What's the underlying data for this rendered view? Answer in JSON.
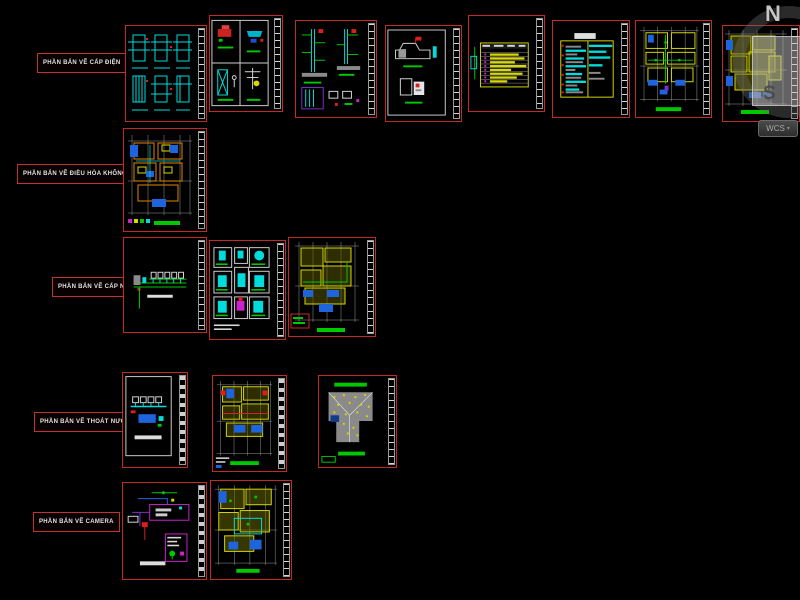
{
  "workspace": {
    "background_color": "#000000",
    "sheet_border_color": "#c22a2a",
    "label_border_color": "#c23232"
  },
  "sections": [
    {
      "label": "PHẦN BẢN VẼ CẤP ĐIỆN"
    },
    {
      "label": "PHẦN BẢN VẼ ĐIỀU HÒA KHÔNG KHÍ"
    },
    {
      "label": "PHẦN BẢN VẼ CẤP NƯỚC"
    },
    {
      "label": "PHẦN BẢN VẼ THOÁT NƯỚC"
    },
    {
      "label": "PHẦN BẢN VẼ CAMERA"
    }
  ],
  "viewcube": {
    "north_label": "N",
    "south_label": "S",
    "wcs_label": "WCS"
  },
  "icons": {
    "dropdown_arrow": "▾"
  },
  "cad_palette": {
    "cyan": "#00dcdc",
    "green": "#00c800",
    "yellow": "#d8d800",
    "blue": "#1e64dc",
    "red": "#dc1e1e",
    "magenta": "#cc22cc",
    "white": "#d8d8d8",
    "gray": "#8a8a8a",
    "orange": "#e08800"
  }
}
